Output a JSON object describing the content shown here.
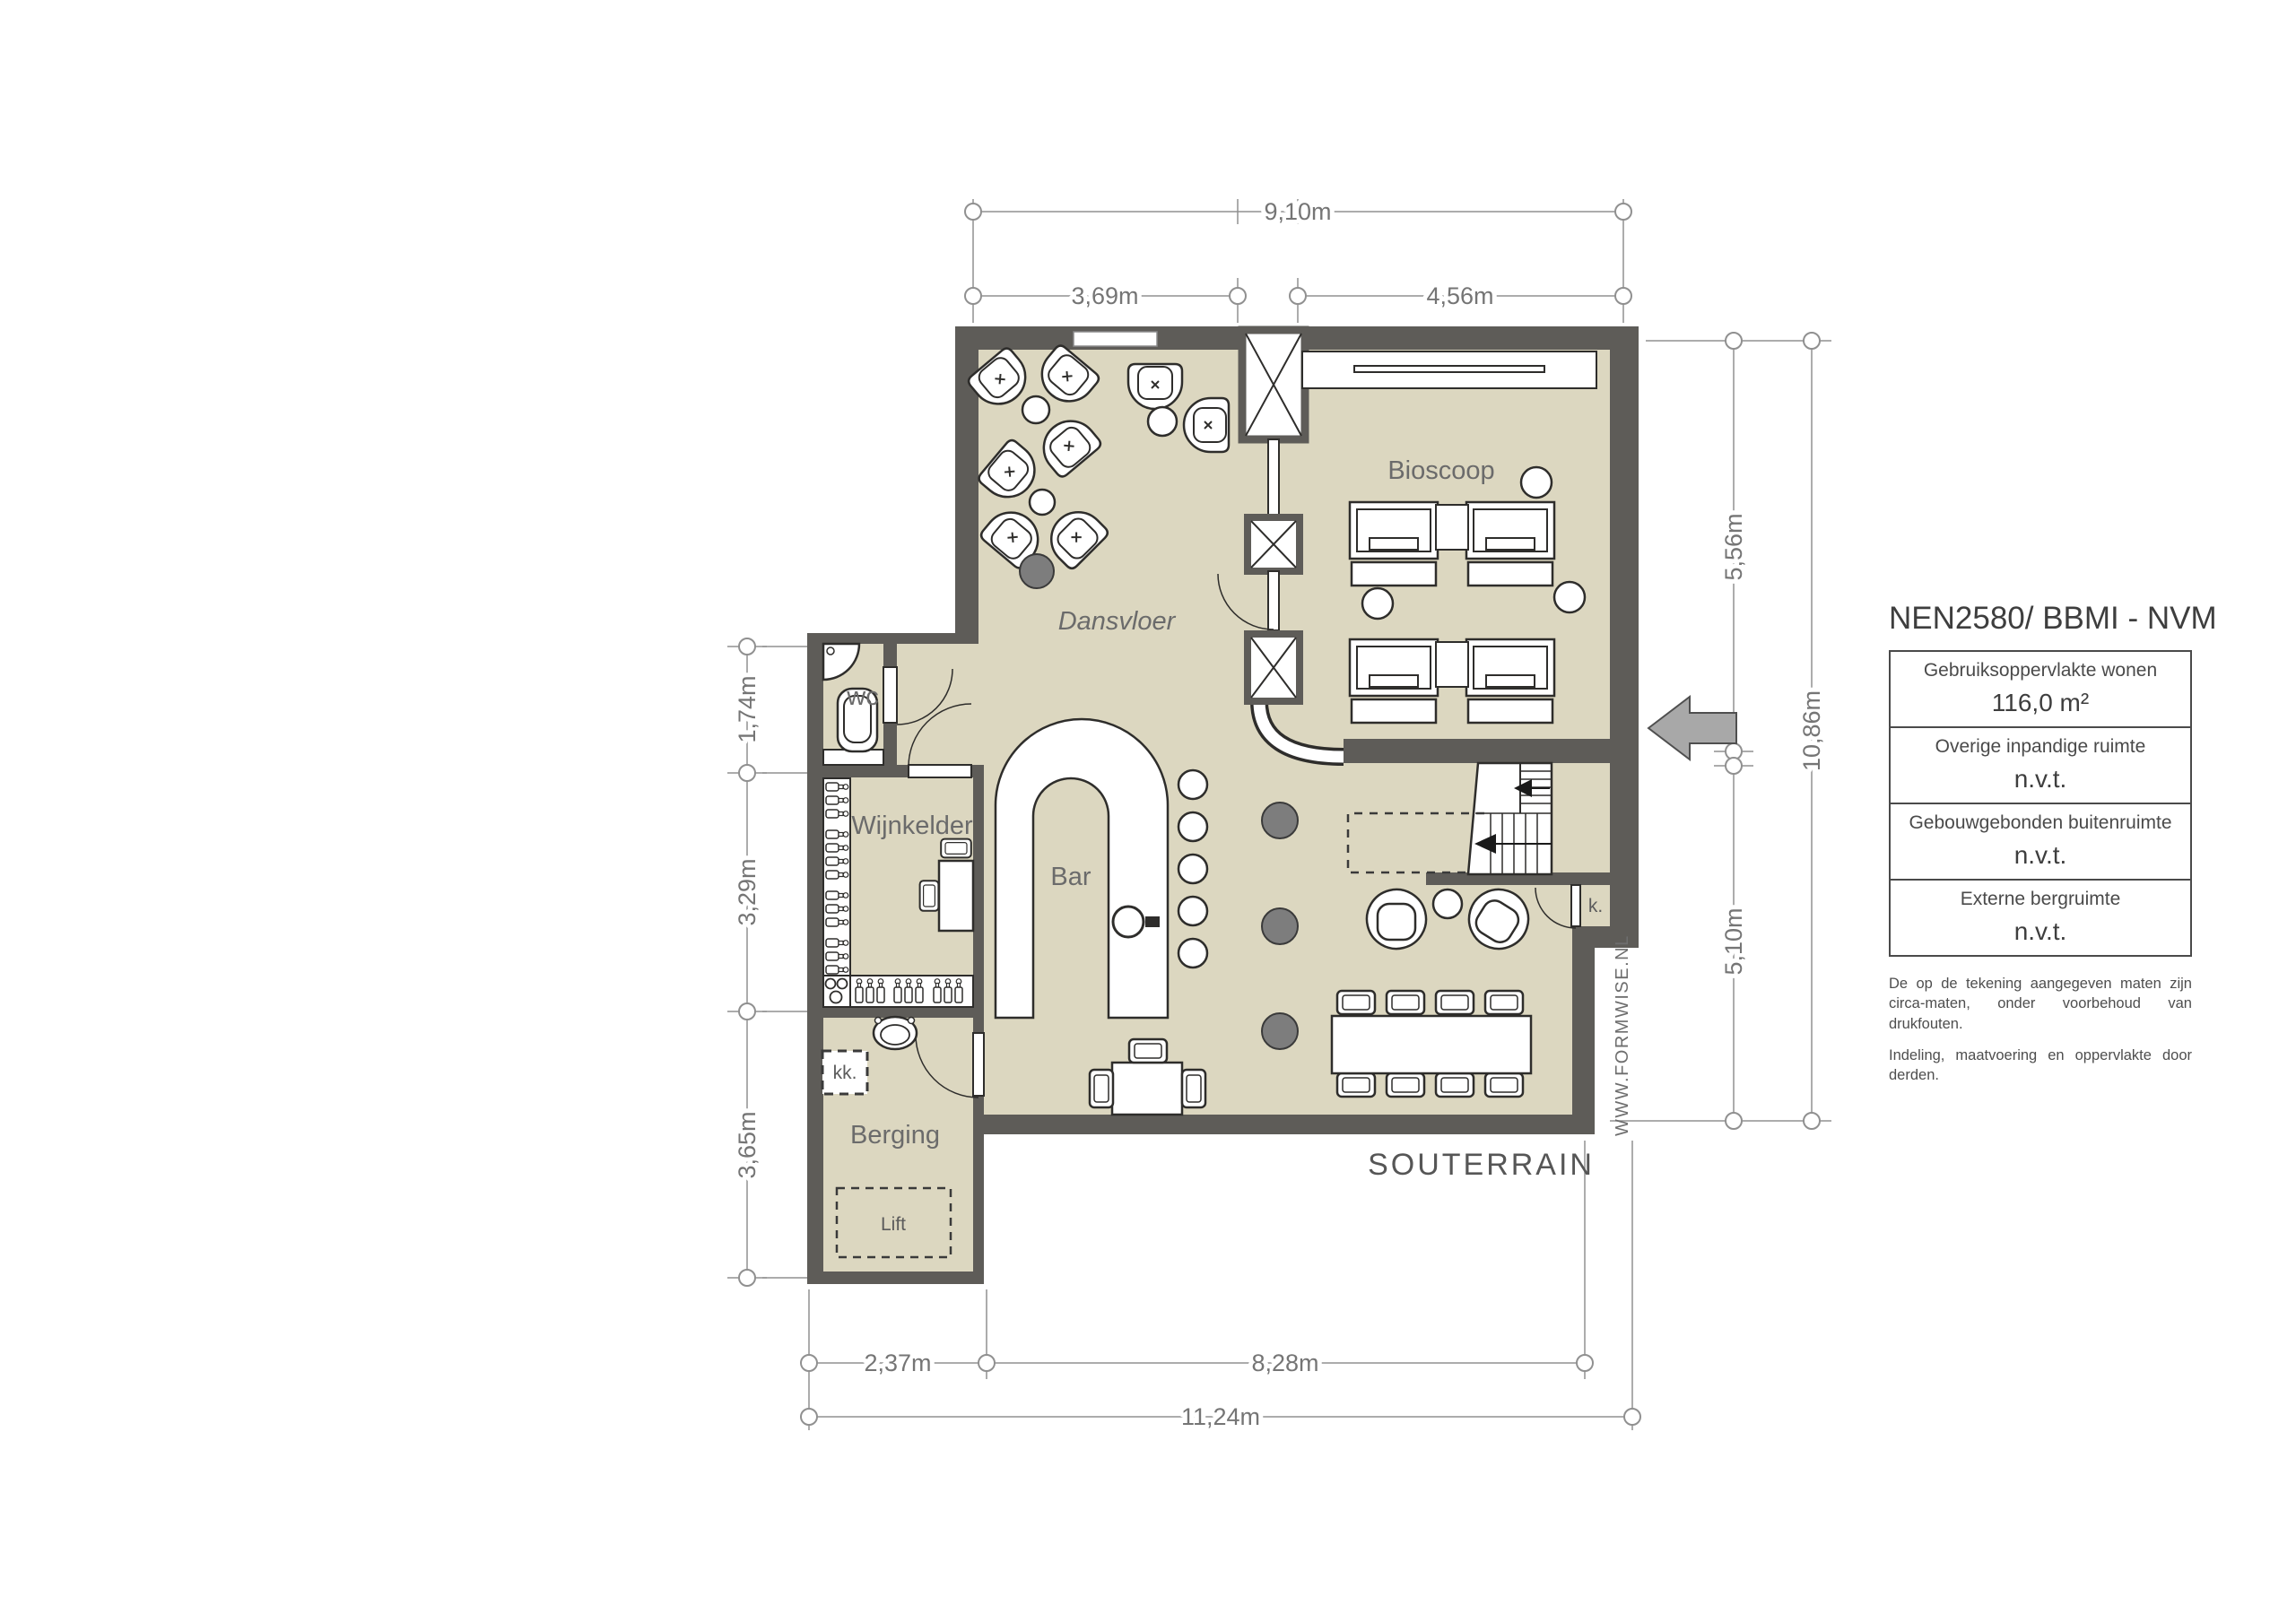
{
  "plan": {
    "floor_label": "SOUTERRAIN",
    "watermark": "WWW.FORMWISE.NL",
    "rooms": {
      "dansvloer": "Dansvloer",
      "bioscoop": "Bioscoop",
      "bar": "Bar",
      "wijnkelder": "Wijnkelder",
      "wc": "wc",
      "berging": "Berging",
      "lift": "Lift",
      "kitchenette": "kk.",
      "closet": "k."
    },
    "dimensions": {
      "top_total": "9,10m",
      "top_left": "3,69m",
      "top_right": "4,56m",
      "left_wc": "1,74m",
      "left_wijnkelder": "3,29m",
      "left_berging": "3,65m",
      "right_upper": "5,56m",
      "right_total": "10,86m",
      "right_lower": "5,10m",
      "bottom_left": "2,37m",
      "bottom_mid": "8,28m",
      "bottom_total": "11,24m"
    }
  },
  "legend": {
    "title": "NEN2580/ BBMI - NVM",
    "rows": [
      {
        "label": "Gebruiksoppervlakte wonen",
        "value": "116,0 m²"
      },
      {
        "label": "Overige inpandige ruimte",
        "value": "n.v.t."
      },
      {
        "label": "Gebouwgebonden buitenruimte",
        "value": "n.v.t."
      },
      {
        "label": "Externe bergruimte",
        "value": "n.v.t."
      }
    ],
    "disclaimer_1": "De op de tekening aangegeven maten zijn circa-maten, onder voorbehoud van drukfouten.",
    "disclaimer_2": "Indeling, maatvoering en oppervlakte door derden."
  },
  "colors": {
    "floor": "#DCD7C0",
    "wall": "#5E5C58",
    "outline": "#2E2D2B",
    "dim_line": "#909090",
    "dim_text": "#757575",
    "room_text": "#6B6B6B",
    "dark_dot": "#7D7D7D"
  }
}
